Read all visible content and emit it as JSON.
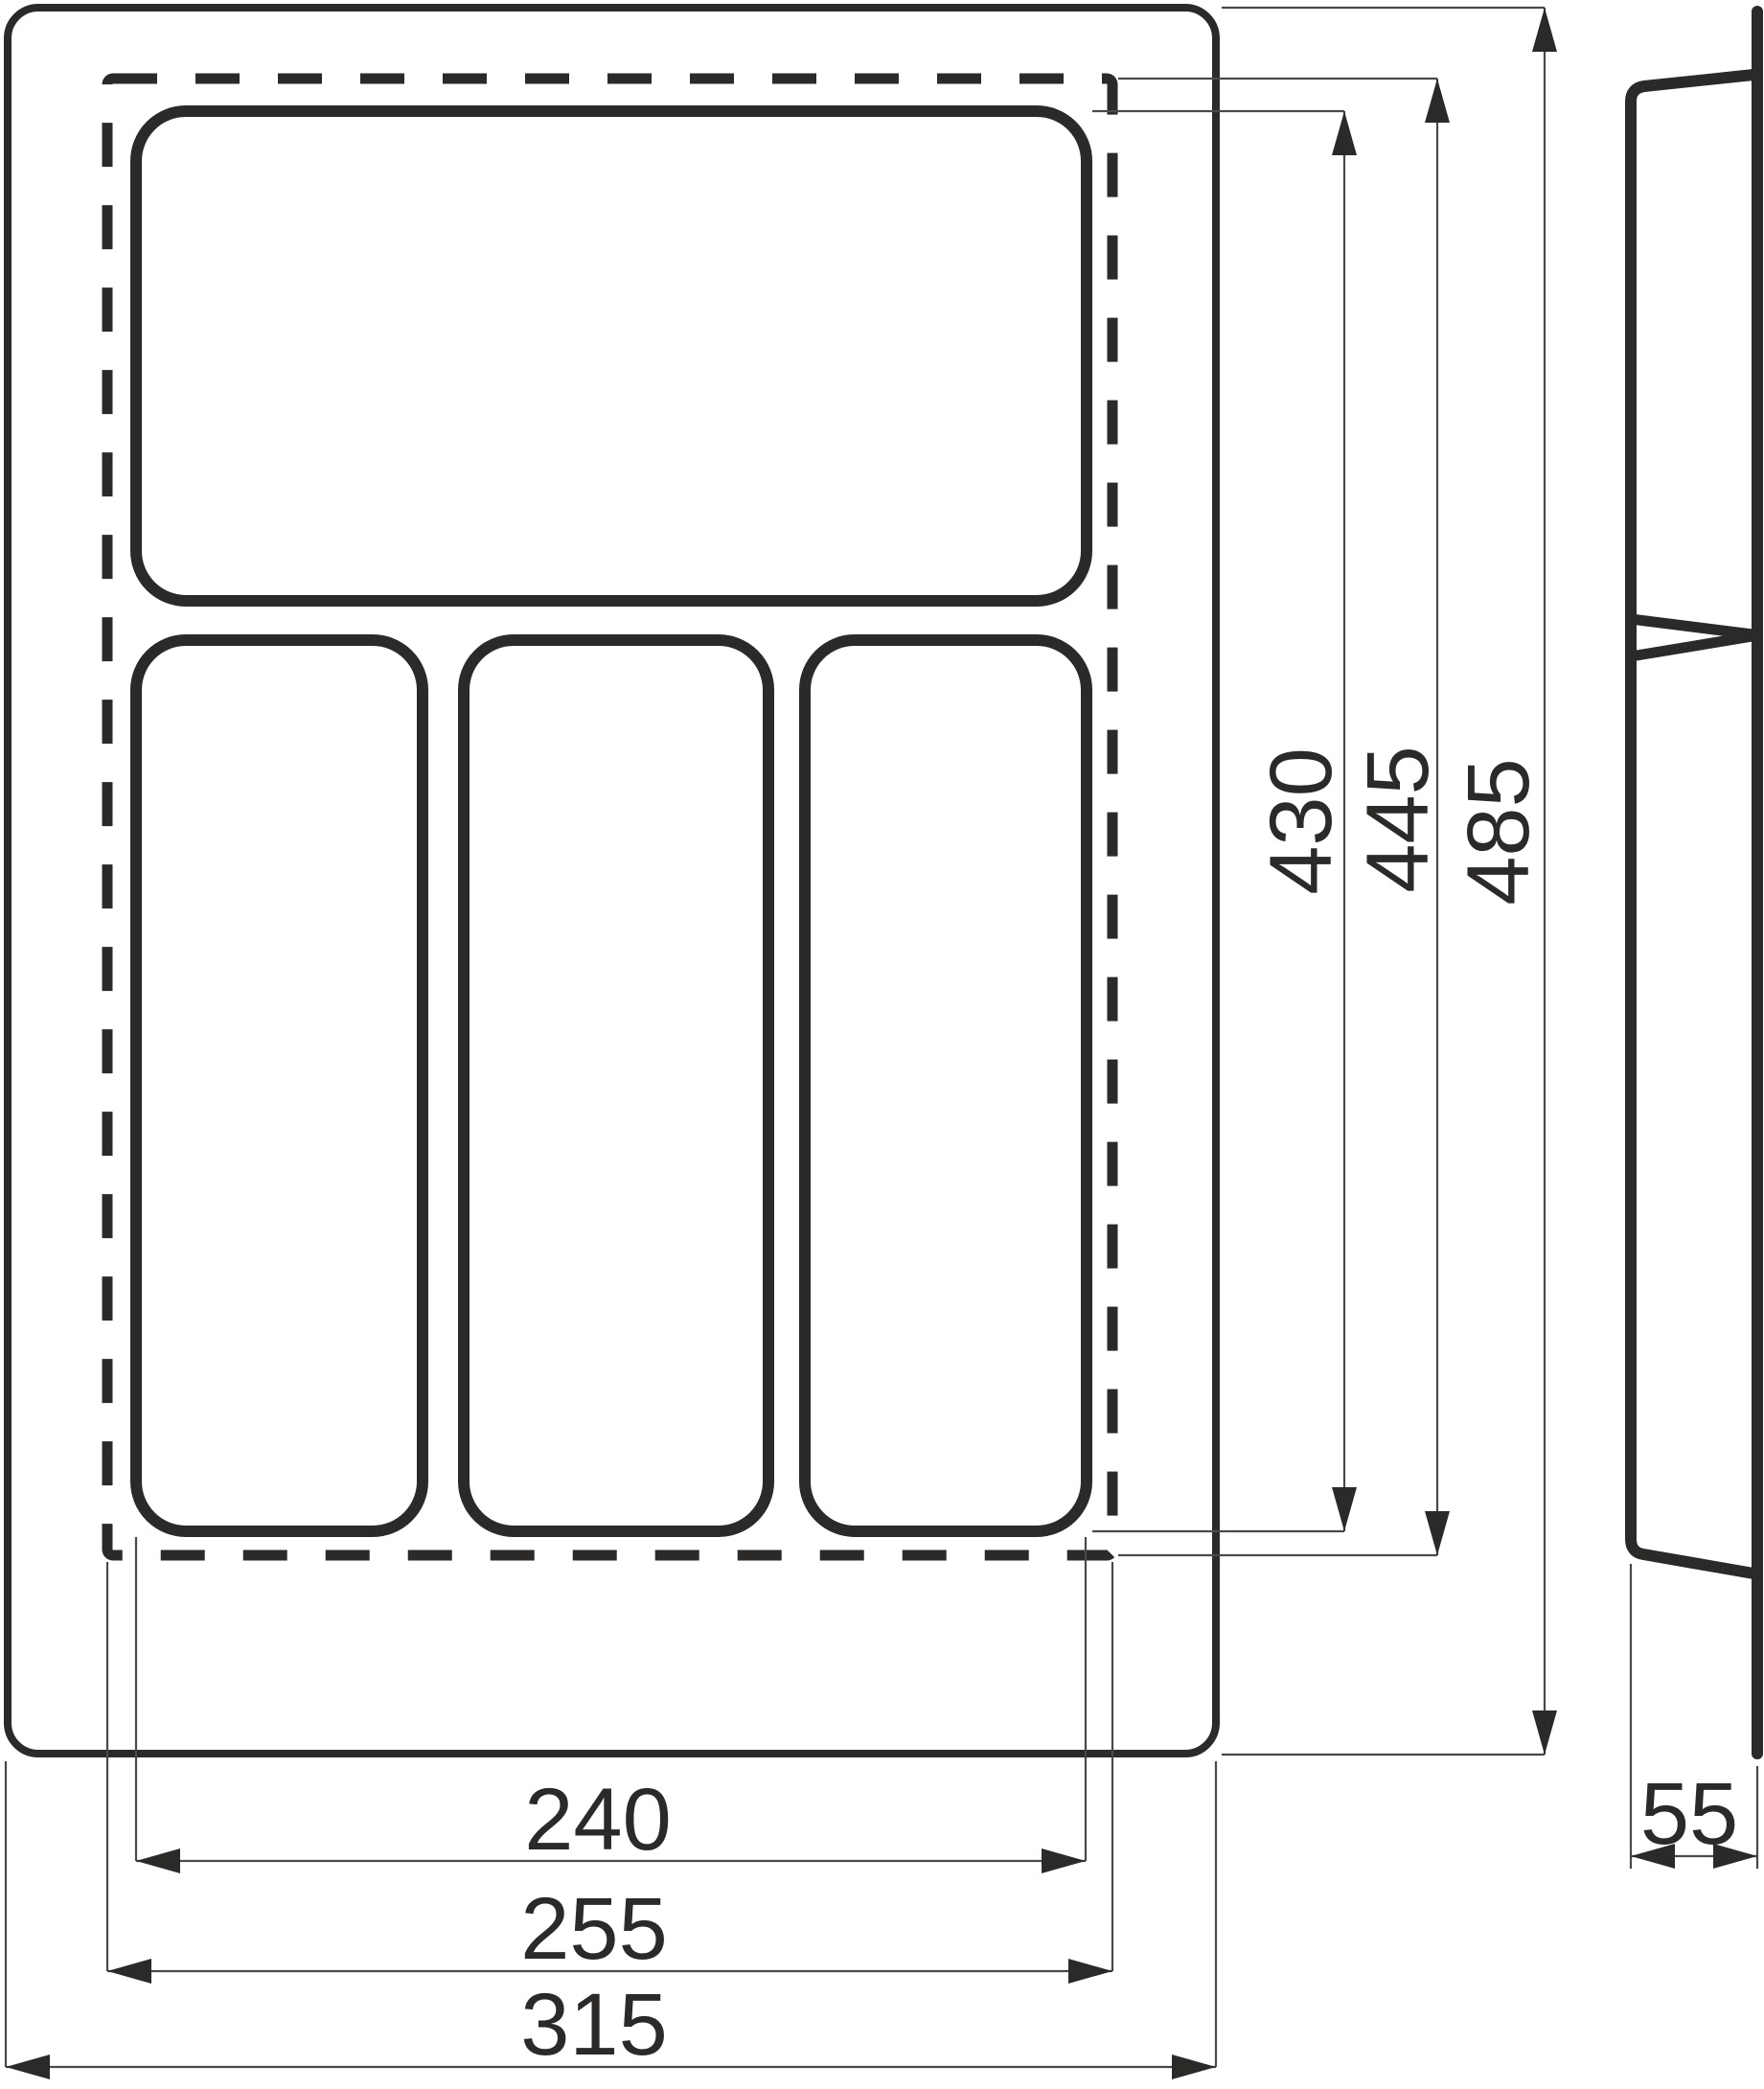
{
  "colors": {
    "line": "#2b2a29",
    "thin_line": "#4a4948",
    "background": "#ffffff"
  },
  "front_view": {
    "dim_compartment_height": "430",
    "dim_trim_height": "445",
    "dim_overall_height": "485",
    "dim_compartment_width": "240",
    "dim_trim_width": "255",
    "dim_overall_width": "315"
  },
  "side_view": {
    "dim_depth": "55"
  }
}
